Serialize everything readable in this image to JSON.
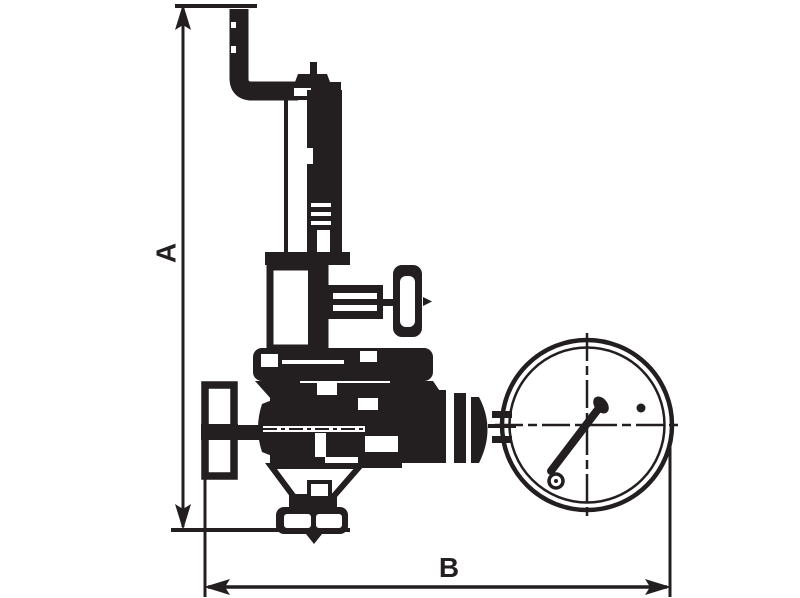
{
  "diagram": {
    "type": "technical-line-drawing",
    "background_color": "#ffffff",
    "line_color": "#231f20",
    "dimension_a": {
      "label": "A",
      "orientation": "vertical"
    },
    "dimension_b": {
      "label": "B",
      "orientation": "horizontal"
    },
    "components": [
      {
        "name": "vent-pipe"
      },
      {
        "name": "bonnet-cap"
      },
      {
        "name": "spring-bonnet"
      },
      {
        "name": "spring-chamber"
      },
      {
        "name": "vent-port-handle"
      },
      {
        "name": "body-flange"
      },
      {
        "name": "handwheel"
      },
      {
        "name": "valve-body"
      },
      {
        "name": "outlet-flange"
      },
      {
        "name": "gauge-connector"
      },
      {
        "name": "pressure-gauge"
      }
    ]
  }
}
